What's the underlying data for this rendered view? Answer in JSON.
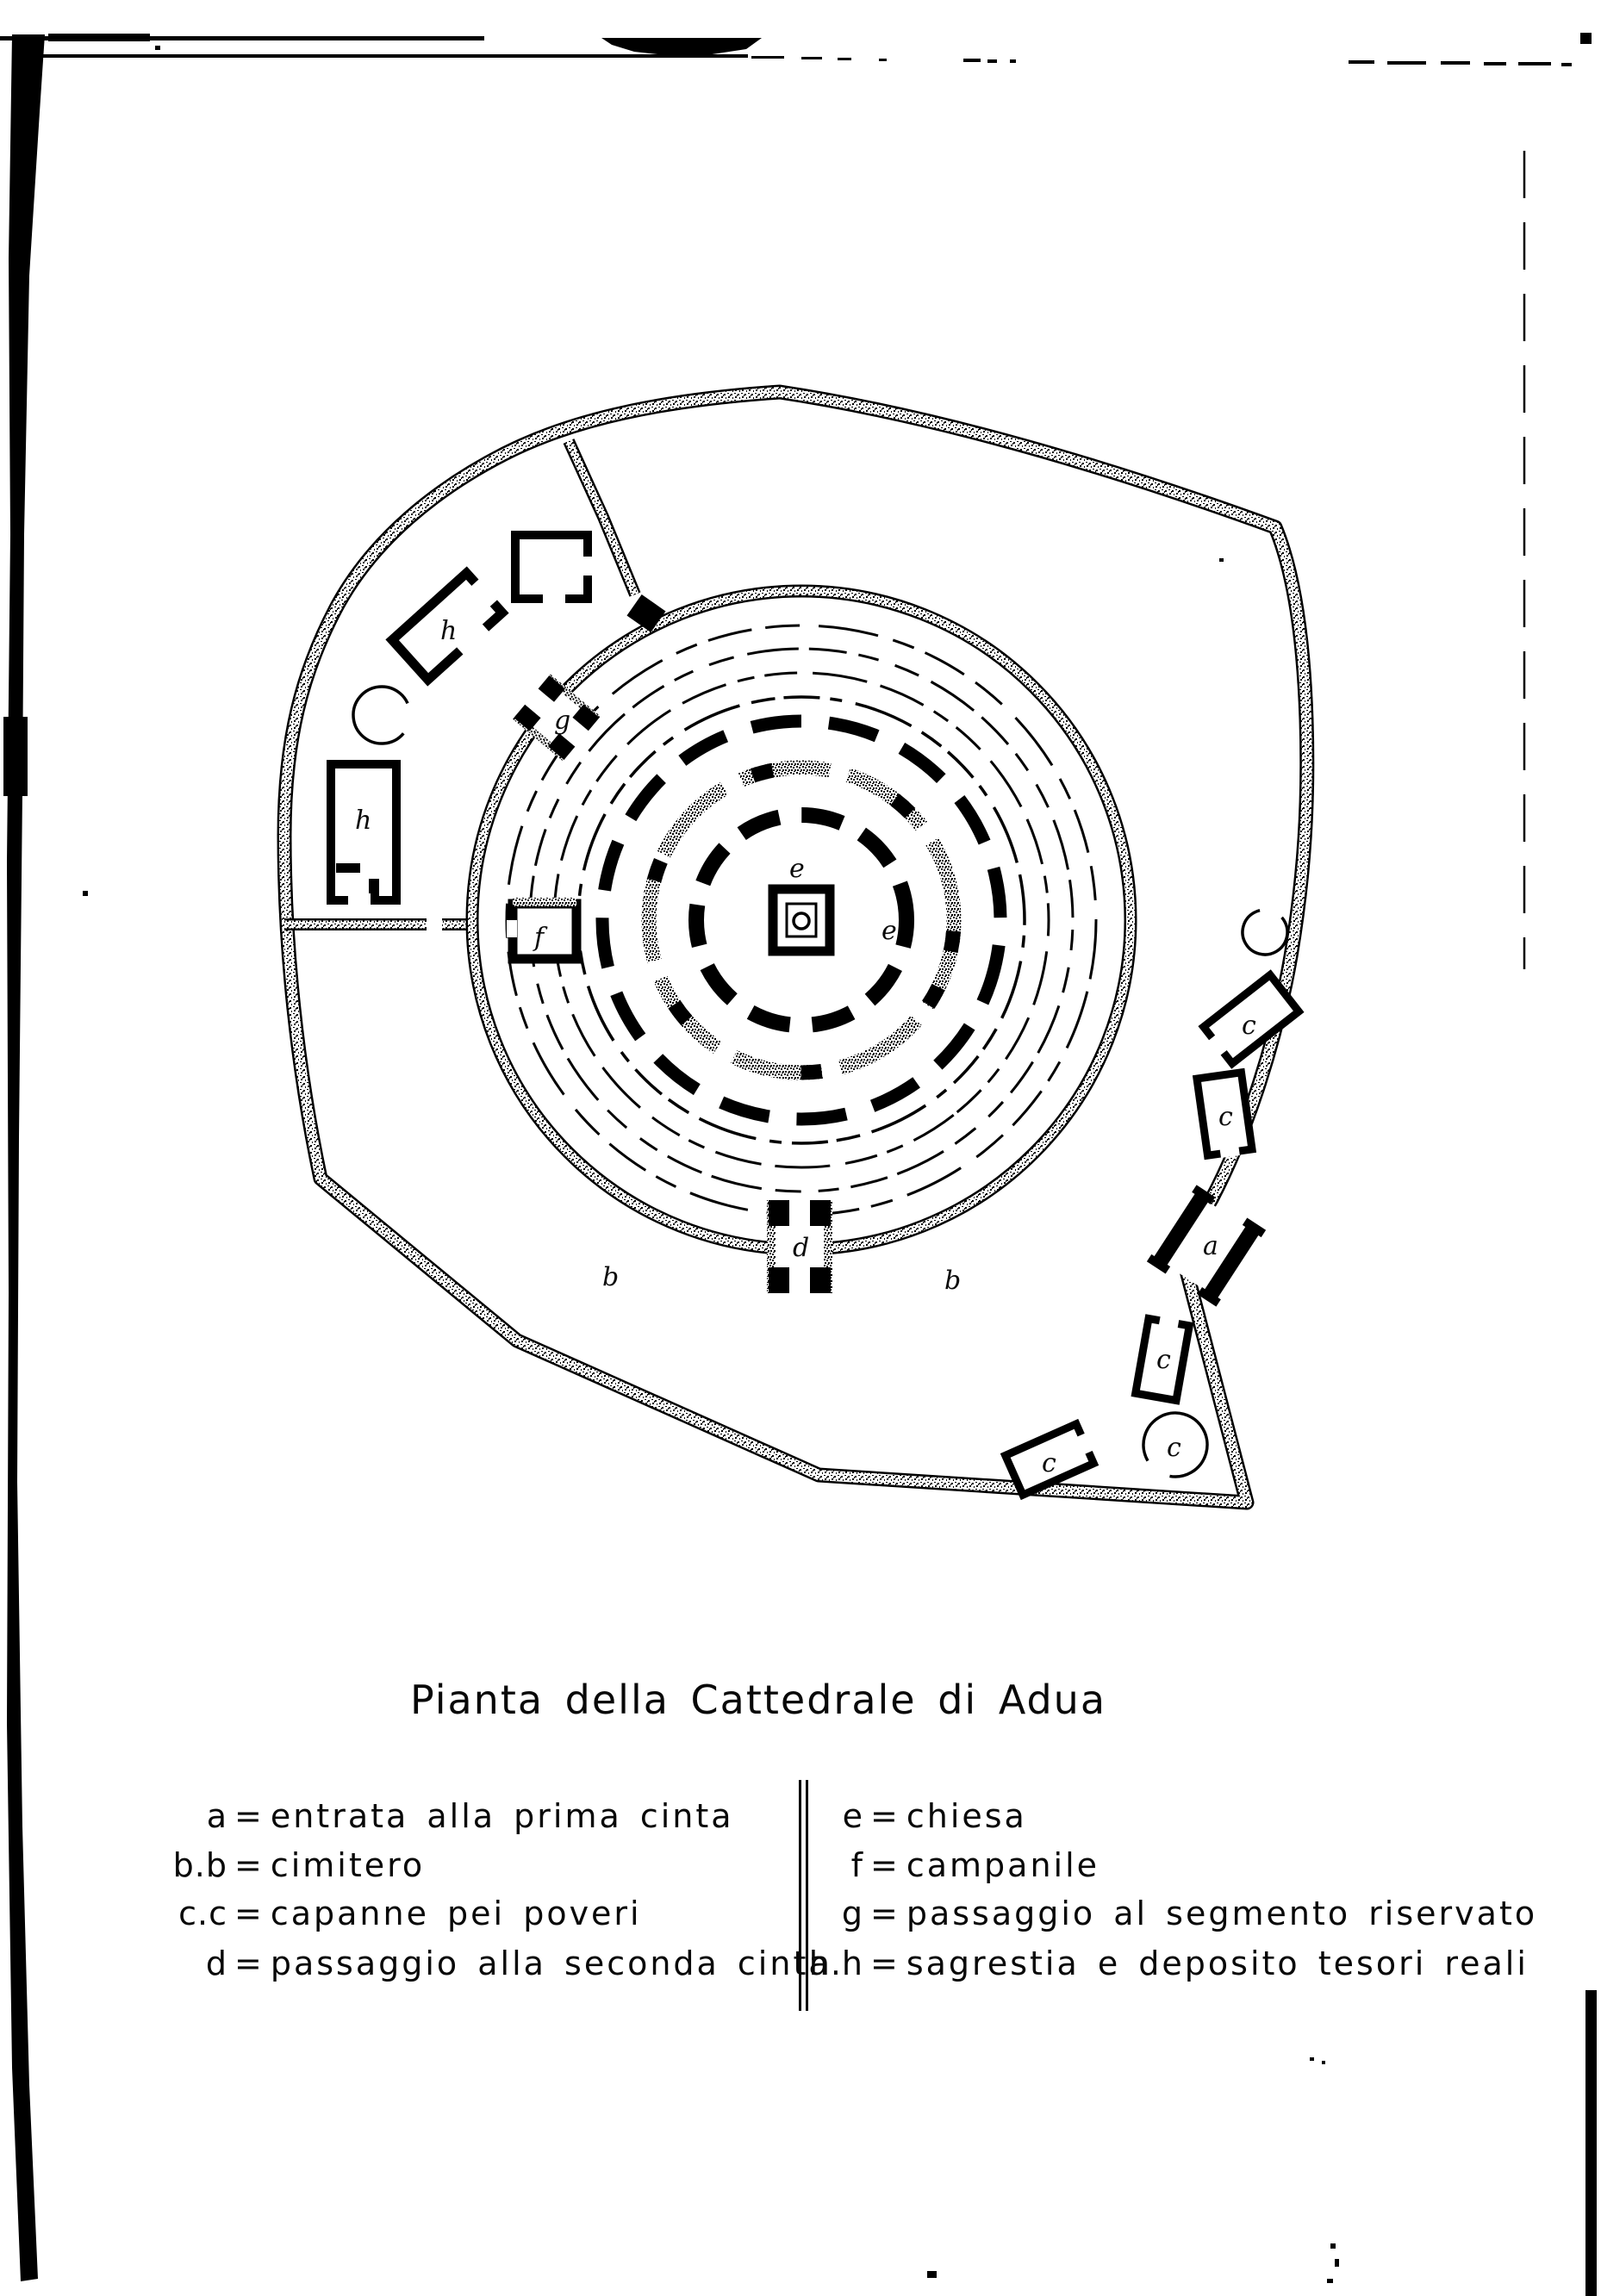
{
  "title": "Pianta della Cattedrale di Adua",
  "legend": {
    "eq": "=",
    "left": [
      {
        "key": "a",
        "text": "entrata alla prima cinta"
      },
      {
        "key": "b.b",
        "text": "cimitero"
      },
      {
        "key": "c.c",
        "text": "capanne pei poveri"
      },
      {
        "key": "d",
        "text": "passaggio alla seconda cinta"
      }
    ],
    "right": [
      {
        "key": "e",
        "text": "chiesa"
      },
      {
        "key": "f",
        "text": "campanile"
      },
      {
        "key": "g",
        "text": "passaggio al segmento riservato"
      },
      {
        "key": "h.h",
        "text": "sagrestia e deposito tesori reali"
      }
    ]
  },
  "plan": {
    "labels": {
      "a": "a",
      "b": "b",
      "c": "c",
      "d": "d",
      "e": "e",
      "f": "f",
      "g": "g",
      "h": "h"
    }
  },
  "colors": {
    "ink": "#000000",
    "paper": "#ffffff"
  }
}
